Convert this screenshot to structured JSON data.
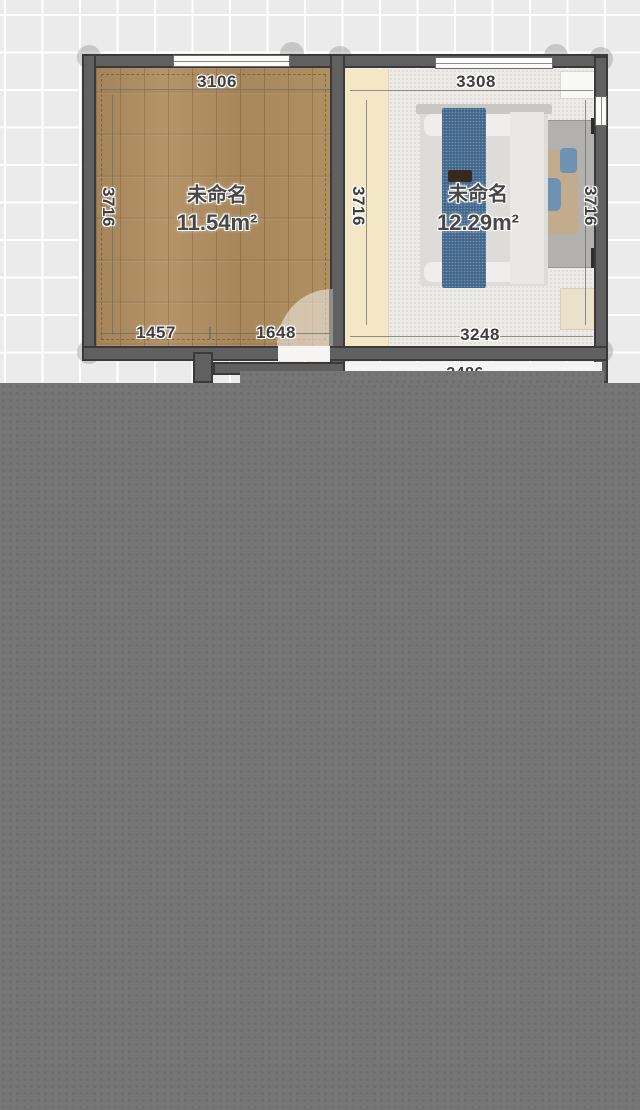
{
  "floorplan": {
    "rooms": [
      {
        "name": "未命名",
        "area": "11.54m²",
        "dim_top": "3106",
        "dim_left": "3716",
        "dim_bottom_left": "1457",
        "dim_bottom_right": "1648"
      },
      {
        "name": "未命名",
        "area": "12.29m²",
        "dim_top": "3308",
        "dim_left": "3716",
        "dim_right": "3716",
        "dim_bottom": "3248"
      }
    ],
    "lower_room": {
      "dim_partial": "2486"
    },
    "colors": {
      "canvas_bg": "#ebebeb",
      "grid_line": "#ffffff",
      "wall": "#606060",
      "wood_floor": "#ac895c",
      "carpet": "#ecebe8",
      "cream_strip": "#f4e7c5",
      "bed_runner": "#40668c",
      "overlay": "#767676"
    }
  }
}
